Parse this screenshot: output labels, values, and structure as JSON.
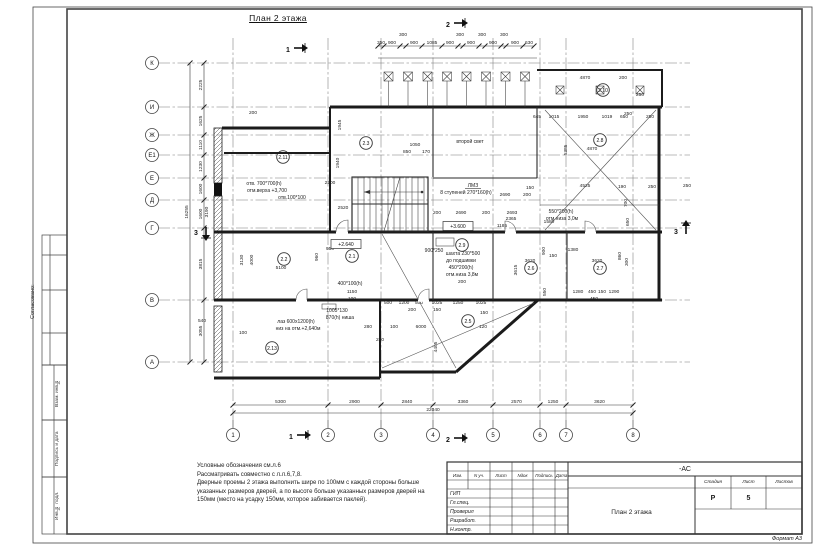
{
  "sheet": {
    "format_label": "Формат А3",
    "side_strip": {
      "approved_label": "Согласовано:",
      "boxes": [
        "Взам. инв.№",
        "Подпись и дата",
        "Инв.№ подл."
      ]
    },
    "notes": [
      "Условные обозначения см.л.6",
      "Рассматривать совместно с л.л.6,7,8.",
      "Дверные проемы  2 этажа выполнить шире по 100мм с каждой стороны больше",
      "указанных размеров дверей, а по высоте больше указанных размеров дверей на",
      "150мм (место на усадку 150мм, которое забивается паклей)."
    ],
    "title_block": {
      "designation": "-АС",
      "header_cols": [
        "Изм.",
        "N уч.",
        "Лист",
        "Nдок",
        "Подпись",
        "Дата"
      ],
      "roles": [
        "ГИП",
        "Гл.спец.",
        "Проверил",
        "Разработ.",
        "Н.контр."
      ],
      "stage_label": "Стадия",
      "sheet_label": "Лист",
      "sheets_label": "Листов",
      "stage_value": "Р",
      "sheet_value": "5",
      "sheets_value": "",
      "drawing_title": "План 2 этажа"
    }
  },
  "plan": {
    "title": "План 2 этажа",
    "v_total": "22040",
    "h_total": "16255",
    "v_axes": [
      {
        "label": "1",
        "x": 233,
        "dim": "5300"
      },
      {
        "label": "2",
        "x": 328,
        "dim": "2900"
      },
      {
        "label": "3",
        "x": 381,
        "dim": "2840"
      },
      {
        "label": "4",
        "x": 433,
        "dim": "3360"
      },
      {
        "label": "5",
        "x": 493,
        "dim": "2570"
      },
      {
        "label": "6",
        "x": 540,
        "dim": "1250"
      },
      {
        "label": "7",
        "x": 566,
        "dim": "3620"
      },
      {
        "label": "8",
        "x": 633,
        "dim": ""
      }
    ],
    "h_axes": [
      {
        "label": "К",
        "y": 63,
        "dim": "2225"
      },
      {
        "label": "И",
        "y": 107,
        "dim": "1625"
      },
      {
        "label": "Ж",
        "y": 135,
        "dim": "1110"
      },
      {
        "label": "Е1",
        "y": 155,
        "dim": "1230"
      },
      {
        "label": "Е",
        "y": 178,
        "dim": "1600"
      },
      {
        "label": "Д",
        "y": 200,
        "dim": "1600"
      },
      {
        "label": "Г",
        "y": 228,
        "dim": "3815"
      },
      {
        "label": "В",
        "y": 300,
        "dim": "3055"
      },
      {
        "label": "А",
        "y": 362,
        "dim": ""
      }
    ],
    "top_chain_ticks": [
      378,
      384,
      400,
      406,
      422,
      442,
      458,
      463,
      479,
      485,
      501,
      506,
      523,
      534
    ],
    "top_dims": [
      {
        "t": "350",
        "x": 381,
        "y": 44
      },
      {
        "t": "900",
        "x": 392,
        "y": 44
      },
      {
        "t": "900",
        "x": 414,
        "y": 44
      },
      {
        "t": "1085",
        "x": 432,
        "y": 44
      },
      {
        "t": "900",
        "x": 450,
        "y": 44
      },
      {
        "t": "900",
        "x": 471,
        "y": 44
      },
      {
        "t": "900",
        "x": 493,
        "y": 44
      },
      {
        "t": "900",
        "x": 515,
        "y": 44
      },
      {
        "t": "630",
        "x": 529,
        "y": 44
      },
      {
        "t": "300",
        "x": 403,
        "y": 36
      },
      {
        "t": "300",
        "x": 460,
        "y": 36
      },
      {
        "t": "300",
        "x": 482,
        "y": 36
      },
      {
        "t": "300",
        "x": 504,
        "y": 36
      }
    ],
    "dims": [
      {
        "t": "4870",
        "x": 585,
        "y": 79
      },
      {
        "t": "200",
        "x": 623,
        "y": 79
      },
      {
        "t": "250",
        "x": 640,
        "y": 96
      },
      {
        "t": "250",
        "x": 628,
        "y": 115
      },
      {
        "t": "645",
        "x": 537,
        "y": 118
      },
      {
        "t": "1015",
        "x": 554,
        "y": 118
      },
      {
        "t": "1950",
        "x": 583,
        "y": 118
      },
      {
        "t": "1019",
        "x": 607,
        "y": 118
      },
      {
        "t": "650",
        "x": 624,
        "y": 118
      },
      {
        "t": "250",
        "x": 650,
        "y": 118
      },
      {
        "t": "5385",
        "x": 567,
        "y": 150,
        "r": 1
      },
      {
        "t": "4870",
        "x": 592,
        "y": 150
      },
      {
        "t": "150",
        "x": 530,
        "y": 189
      },
      {
        "t": "4525",
        "x": 585,
        "y": 187
      },
      {
        "t": "190",
        "x": 622,
        "y": 188
      },
      {
        "t": "250",
        "x": 652,
        "y": 188
      },
      {
        "t": "250",
        "x": 687,
        "y": 187
      },
      {
        "t": "700",
        "x": 627,
        "y": 203,
        "r": 1
      },
      {
        "t": "650",
        "x": 629,
        "y": 222,
        "r": 1
      },
      {
        "t": "860",
        "x": 621,
        "y": 256,
        "r": 1
      },
      {
        "t": "300",
        "x": 628,
        "y": 262,
        "r": 1
      },
      {
        "t": "1050",
        "x": 415,
        "y": 146
      },
      {
        "t": "850",
        "x": 407,
        "y": 153
      },
      {
        "t": "170",
        "x": 426,
        "y": 153
      },
      {
        "t": "2200",
        "x": 330,
        "y": 184
      },
      {
        "t": "2520",
        "x": 343,
        "y": 209
      },
      {
        "t": "1945",
        "x": 341,
        "y": 125,
        "r": 1
      },
      {
        "t": "1940",
        "x": 339,
        "y": 163,
        "r": 1
      },
      {
        "t": "200",
        "x": 253,
        "y": 114
      },
      {
        "t": "3190",
        "x": 208,
        "y": 212,
        "r": 1
      },
      {
        "t": "200",
        "x": 437,
        "y": 214
      },
      {
        "t": "2690",
        "x": 461,
        "y": 214
      },
      {
        "t": "200",
        "x": 486,
        "y": 214
      },
      {
        "t": "2693",
        "x": 512,
        "y": 214
      },
      {
        "t": "2365",
        "x": 511,
        "y": 220
      },
      {
        "t": "1185",
        "x": 502,
        "y": 227
      },
      {
        "t": "1580",
        "x": 549,
        "y": 223
      },
      {
        "t": "1380",
        "x": 573,
        "y": 251
      },
      {
        "t": "900",
        "x": 545,
        "y": 251,
        "r": 1
      },
      {
        "t": "150",
        "x": 553,
        "y": 257
      },
      {
        "t": "3620",
        "x": 530,
        "y": 262
      },
      {
        "t": "3620",
        "x": 597,
        "y": 262
      },
      {
        "t": "3615",
        "x": 517,
        "y": 270,
        "r": 1
      },
      {
        "t": "200",
        "x": 527,
        "y": 196
      },
      {
        "t": "2690",
        "x": 505,
        "y": 196
      },
      {
        "t": "3130",
        "x": 243,
        "y": 260,
        "r": 1
      },
      {
        "t": "4000",
        "x": 253,
        "y": 260,
        "r": 1
      },
      {
        "t": "5100",
        "x": 281,
        "y": 269
      },
      {
        "t": "950",
        "x": 330,
        "y": 250
      },
      {
        "t": "960",
        "x": 318,
        "y": 257,
        "r": 1
      },
      {
        "t": "1150",
        "x": 352,
        "y": 293
      },
      {
        "t": "100",
        "x": 352,
        "y": 300
      },
      {
        "t": "500",
        "x": 388,
        "y": 304
      },
      {
        "t": "1200",
        "x": 404,
        "y": 304
      },
      {
        "t": "500",
        "x": 419,
        "y": 304
      },
      {
        "t": "1025",
        "x": 437,
        "y": 304
      },
      {
        "t": "1250",
        "x": 458,
        "y": 304
      },
      {
        "t": "1025",
        "x": 481,
        "y": 304
      },
      {
        "t": "200",
        "x": 412,
        "y": 311
      },
      {
        "t": "150",
        "x": 437,
        "y": 311
      },
      {
        "t": "150",
        "x": 484,
        "y": 314
      },
      {
        "t": "280",
        "x": 368,
        "y": 328
      },
      {
        "t": "100",
        "x": 394,
        "y": 328
      },
      {
        "t": "6000",
        "x": 421,
        "y": 328
      },
      {
        "t": "120",
        "x": 483,
        "y": 328
      },
      {
        "t": "4405",
        "x": 437,
        "y": 347,
        "r": 1
      },
      {
        "t": "540",
        "x": 202,
        "y": 322
      },
      {
        "t": "100",
        "x": 243,
        "y": 334
      },
      {
        "t": "280",
        "x": 380,
        "y": 341
      },
      {
        "t": "1280",
        "x": 578,
        "y": 293
      },
      {
        "t": "450",
        "x": 592,
        "y": 293
      },
      {
        "t": "150",
        "x": 602,
        "y": 293
      },
      {
        "t": "1290",
        "x": 614,
        "y": 293
      },
      {
        "t": "450",
        "x": 594,
        "y": 300
      },
      {
        "t": "550",
        "x": 546,
        "y": 292,
        "r": 1
      },
      {
        "t": "200",
        "x": 462,
        "y": 283
      }
    ],
    "rooms": [
      {
        "tag": "2.11",
        "x": 283,
        "y": 157
      },
      {
        "tag": "2.3",
        "x": 366,
        "y": 143
      },
      {
        "tag": "2.10",
        "x": 603,
        "y": 90
      },
      {
        "tag": "2.8",
        "x": 600,
        "y": 140
      },
      {
        "tag": "2.2",
        "x": 284,
        "y": 259
      },
      {
        "tag": "2.1",
        "x": 352,
        "y": 256
      },
      {
        "tag": "2.9",
        "x": 462,
        "y": 245
      },
      {
        "tag": "2.6",
        "x": 531,
        "y": 268
      },
      {
        "tag": "2.7",
        "x": 600,
        "y": 268
      },
      {
        "tag": "2.5",
        "x": 468,
        "y": 321
      },
      {
        "tag": "2.13",
        "x": 272,
        "y": 348
      }
    ],
    "annotations": [
      {
        "t": "второй свет",
        "x": 470,
        "y": 143
      },
      {
        "t": "ЛМЗ",
        "x": 473,
        "y": 187,
        "u": 1
      },
      {
        "t": "8 ступеней 270*160(h)",
        "x": 466,
        "y": 194
      },
      {
        "t": "отв. 700*700(h)",
        "x": 264,
        "y": 185
      },
      {
        "t": "отм.верха +3,700",
        "x": 267,
        "y": 192
      },
      {
        "t": "отв.100*100",
        "x": 292,
        "y": 199
      },
      {
        "t": "шахта 230*500",
        "x": 463,
        "y": 255
      },
      {
        "t": "до подшивки",
        "x": 461,
        "y": 262
      },
      {
        "t": "450*200(h)",
        "x": 461,
        "y": 269
      },
      {
        "t": "отм.низа 3,8м",
        "x": 462,
        "y": 276
      },
      {
        "t": "550*200(h)",
        "x": 561,
        "y": 213
      },
      {
        "t": "отм.низа 3,0м",
        "x": 562,
        "y": 220
      },
      {
        "t": "лаз 600х1200(h)",
        "x": 296,
        "y": 323
      },
      {
        "t": "низ на отм.+2,640м",
        "x": 298,
        "y": 330
      },
      {
        "t": "1005*130",
        "x": 337,
        "y": 312
      },
      {
        "t": "870(h) ниша",
        "x": 340,
        "y": 319
      },
      {
        "t": "400*100(h)",
        "x": 350,
        "y": 285
      },
      {
        "t": "900*250",
        "x": 434,
        "y": 252
      }
    ],
    "levels": [
      {
        "t": "+3.600",
        "x": 458,
        "y": 228
      },
      {
        "t": "+2.640",
        "x": 346,
        "y": 246
      }
    ],
    "sections": [
      {
        "label": "1",
        "x": 288,
        "y": 50,
        "dir": "right"
      },
      {
        "label": "2",
        "x": 448,
        "y": 25,
        "dir": "right"
      },
      {
        "label": "1",
        "x": 291,
        "y": 437,
        "dir": "right"
      },
      {
        "label": "2",
        "x": 448,
        "y": 440,
        "dir": "right"
      },
      {
        "label": "3",
        "x": 676,
        "y": 232,
        "dir": "up"
      },
      {
        "label": "3",
        "x": 196,
        "y": 233,
        "dir": "down"
      }
    ]
  }
}
